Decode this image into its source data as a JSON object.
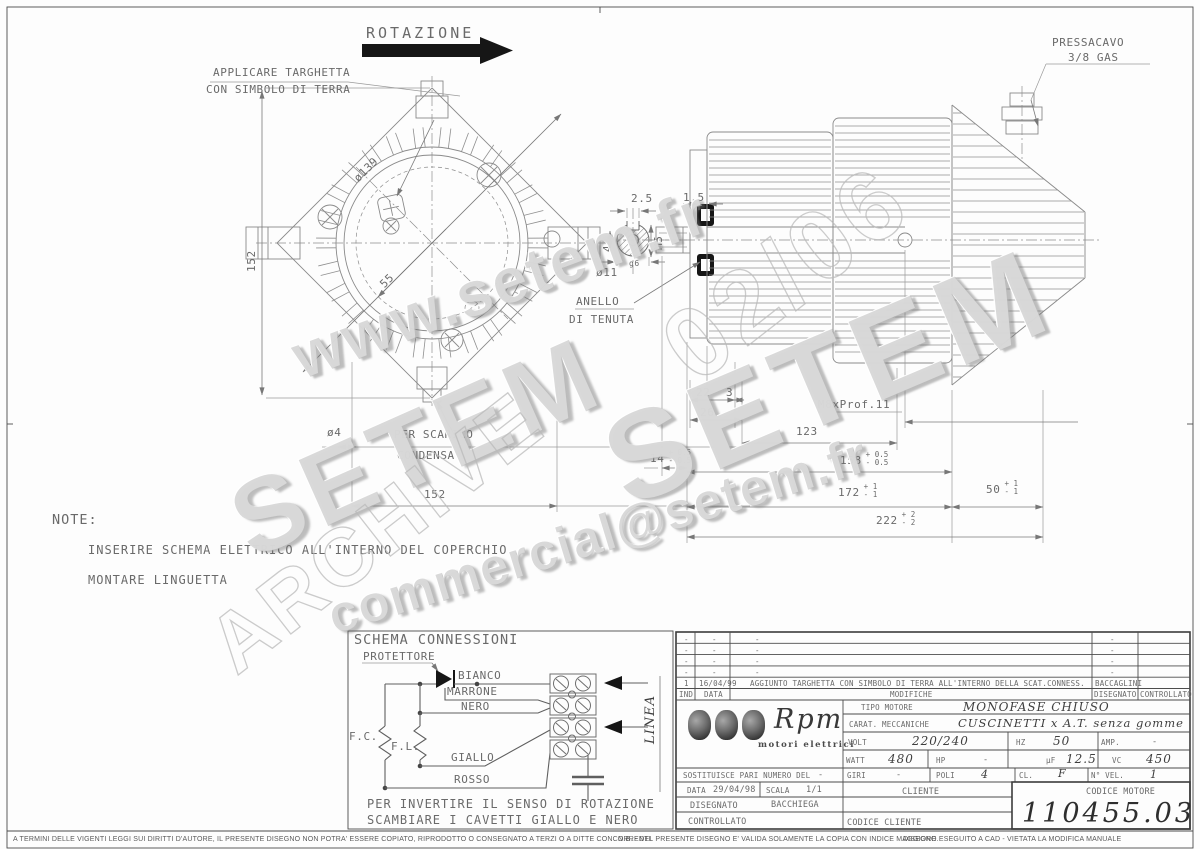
{
  "sheet": {
    "watermarks": {
      "url": "www.setem.fr",
      "setem_left": "SETEM",
      "setem_right": "SETEM",
      "archive": "ARCHIVE",
      "email": "commercial@setem.fr",
      "stamp": "02/06"
    },
    "top": {
      "rotation": "ROTAZIONE",
      "targhetta_line1": "APPLICARE TARGHETTA",
      "targhetta_line2": "CON SIMBOLO DI TERRA",
      "pressacavo_line1": "PRESSACAVO",
      "pressacavo_line2": "3/8 GAS"
    },
    "front_view": {
      "dim_diameter": "ø139",
      "dim_height": "152",
      "dim_radius": "55",
      "dim_width_bottom": "152",
      "dim_drain_hole": "ø4",
      "drain_line1": "PER SCARICO",
      "drain_line2": "CONDENSA"
    },
    "shaft_detail": {
      "dim_key_width": "2.5",
      "dim_thread": "M5",
      "dim_key_depth": "4",
      "dim_shaft_dia": "ø11",
      "dim_shaft_tol": "g6",
      "seal_line1": "ANELLO",
      "seal_line2": "DI TENUTA",
      "dim_seal": "1.5"
    },
    "side_view": {
      "dim_a": "22",
      "dim_b": "3",
      "dim_c": "26",
      "dim_thread": "M8xProf.11",
      "dim_d": "123",
      "dim_e": "14",
      "dim_e_plus": "+ 0.5",
      "dim_e_minus": "- 0.5",
      "dim_f": "158",
      "dim_f_plus": "+ 0.5",
      "dim_f_minus": "- 0.5",
      "dim_g": "172",
      "dim_g_plus": "+ 1",
      "dim_g_minus": "- 1",
      "dim_h": "50",
      "dim_h_plus": "+ 1",
      "dim_h_minus": "- 1",
      "dim_i": "222",
      "dim_i_plus": "+ 2",
      "dim_i_minus": "- 2"
    },
    "notes": {
      "title": "NOTE:",
      "line1": "INSERIRE SCHEMA ELETTRICO ALL'INTERNO DEL COPERCHIO",
      "line2": "MONTARE LINGUETTA"
    },
    "schema": {
      "title": "SCHEMA CONNESSIONI",
      "protettore": "PROTETTORE",
      "bianco": "BIANCO",
      "marrone": "MARRONE",
      "nero": "NERO",
      "giallo": "GIALLO",
      "rosso": "ROSSO",
      "fc": "F.C.",
      "fl": "F.L.",
      "linea": "LINEA",
      "note_line1": "PER INVERTIRE IL SENSO DI ROTAZIONE",
      "note_line2": "SCAMBIARE I CAVETTI GIALLO E NERO"
    },
    "title_block": {
      "revisions": [
        {
          "ind": "-",
          "data": "-",
          "modifiche": "-",
          "disegnato": "-"
        },
        {
          "ind": "-",
          "data": "-",
          "modifiche": "-",
          "disegnato": "-"
        },
        {
          "ind": "-",
          "data": "-",
          "modifiche": "-",
          "disegnato": "-"
        },
        {
          "ind": "-",
          "data": "-",
          "modifiche": "-",
          "disegnato": "-"
        },
        {
          "ind": "1",
          "data": "16/04/99",
          "modifiche": "AGGIUNTO TARGHETTA CON SIMBOLO DI TERRA ALL'INTERNO DELLA SCAT.CONNESS.",
          "disegnato": "BACCAGLINI"
        }
      ],
      "headers": {
        "ind": "IND",
        "data": "DATA",
        "modifiche": "MODIFICHE",
        "disegnato": "DISEGNATO",
        "controllato": "CONTROLLATO"
      },
      "logo": {
        "name": "Rpm",
        "subtitle": "motori elettrici"
      },
      "tipo_label": "TIPO MOTORE",
      "tipo_value": "MONOFASE CHIUSO",
      "carat_label": "CARAT. MECCANICHE",
      "carat_value": "CUSCINETTI x A.T. senza gomme",
      "volt_label": "VOLT",
      "volt_value": "220/240",
      "hz_label": "HZ",
      "hz_value": "50",
      "amp_label": "AMP.",
      "amp_value": "-",
      "watt_label": "WATT",
      "watt_value": "480",
      "hp_label": "HP",
      "hp_value": "-",
      "uf_label": "µF",
      "uf_value": "12.5",
      "vc_label": "VC",
      "vc_value": "450",
      "sostituisce_label": "SOSTITUISCE PARI NUMERO DEL",
      "sostituisce_value": "-",
      "giri_label": "GIRI",
      "giri_value": "-",
      "poli_label": "POLI",
      "poli_value": "4",
      "cl_label": "CL.",
      "cl_value": "F",
      "nvel_label": "N° VEL.",
      "nvel_value": "1",
      "data_label": "DATA",
      "data_value": "29/04/98",
      "scala_label": "SCALA",
      "scala_value": "1/1",
      "cliente_label": "CLIENTE",
      "codice_motore_label": "CODICE MOTORE",
      "disegnato_label": "DISEGNATO",
      "disegnato_value": "BACCHIEGA",
      "controllato_label": "CONTROLLATO",
      "codice_cliente_label": "CODICE CLIENTE",
      "codice_motore_value": "110455.03"
    },
    "footer": {
      "left": "A TERMINI DELLE VIGENTI LEGGI SUI DIRITTI D'AUTORE, IL PRESENTE DISEGNO NON POTRA' ESSERE COPIATO, RIPRODOTTO O CONSEGNATO A TERZI O A DITTE CONCORRENTI.",
      "nb": "N.B. - DEL PRESENTE DISEGNO E' VALIDA SOLAMENTE LA COPIA CON INDICE MAGGIORE.",
      "cad": "DISEGNO ESEGUITO A CAD - VIETATA LA MODIFICA MANUALE"
    }
  }
}
